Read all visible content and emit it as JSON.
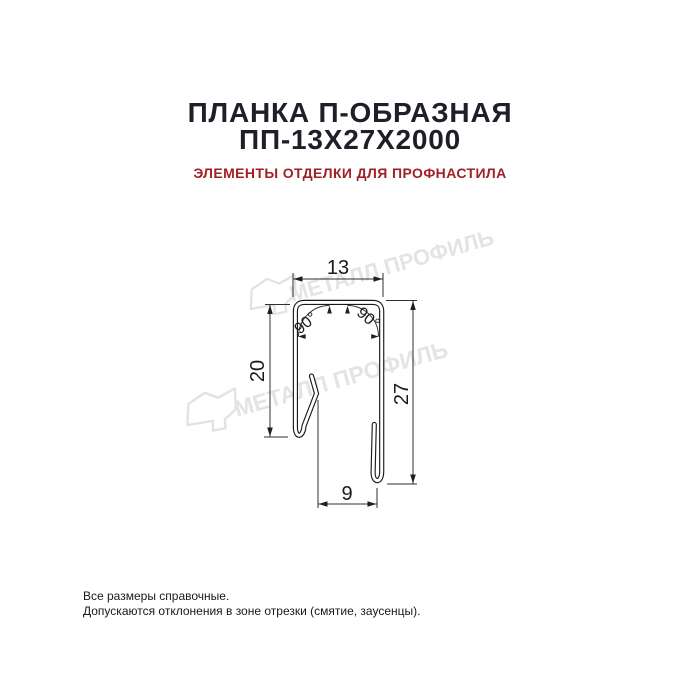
{
  "header": {
    "title_line1": "ПЛАНКА П-ОБРАЗНАЯ",
    "title_line2": "ПП-13Х27Х2000",
    "subtitle": "ЭЛЕМЕНТЫ ОТДЕЛКИ ДЛЯ ПРОФНАСТИЛА"
  },
  "drawing": {
    "type": "technical-cross-section",
    "product": "U-shaped strip profile",
    "dimensions": {
      "top_width": "13",
      "left_height": "20",
      "right_height": "27",
      "bottom_width": "9",
      "angle_left": "90°",
      "angle_right": "90°"
    }
  },
  "watermark": {
    "brand": "МЕТАЛЛ ПРОФИЛЬ"
  },
  "footer": {
    "line1": "Все размеры справочные.",
    "line2": "Допускаются отклонения в зоне отрезки (смятие, заусенцы)."
  },
  "colors": {
    "title": "#211e29",
    "subtitle_accent": "#9f2126",
    "drawing_line": "#1a1a1a",
    "dimension_line": "#2f2f2f",
    "watermark": "#e4e4e4",
    "background": "#ffffff"
  }
}
